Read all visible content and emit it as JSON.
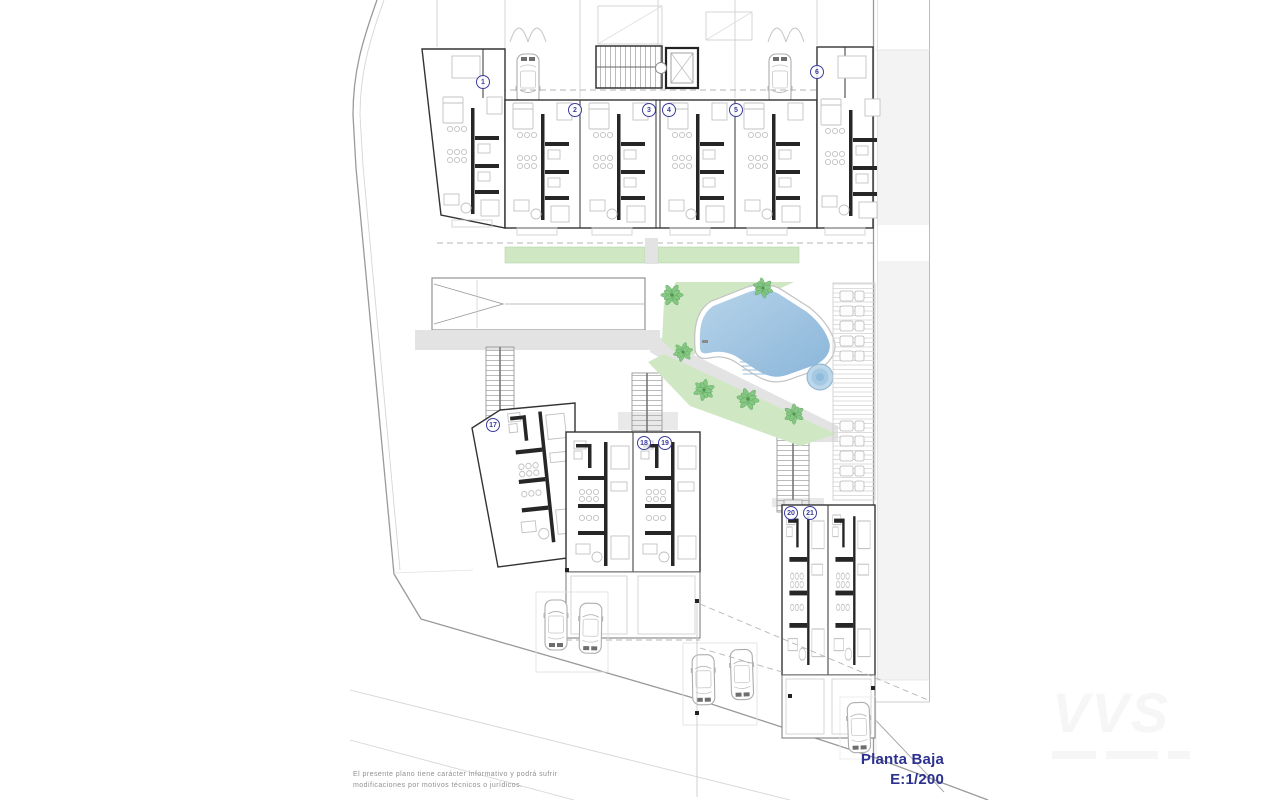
{
  "plan": {
    "title": {
      "name": "Planta Baja",
      "scale": "E:1/200"
    },
    "disclaimer": {
      "line1": "El  presente  plano  tiene  carácter  informativo  y  podrá  sufrir",
      "line2": "modificaciones por motivos técnicos o jurídicos."
    },
    "watermark": {
      "text": "VVS"
    },
    "units": {
      "top_row": [
        "1",
        "2",
        "3",
        "4",
        "5",
        "6"
      ],
      "bottom_row": [
        "17",
        "18",
        "19",
        "20",
        "21"
      ]
    }
  },
  "colors": {
    "accent_blue": "#2c3190",
    "badge_blue": "#3c3c9e",
    "disclaimer_gray": "#909090",
    "watermark_gray": "#f6f6f6",
    "wall": "#262626",
    "furniture": "#c2c2c2",
    "boundary": "#9a9a9a",
    "path_gray": "#e3e3e3",
    "green_area": "#cfe7c3",
    "palm_green": "#7cc57c",
    "pool_light": "#b7d4ea",
    "pool_dark": "#8ab5d9",
    "deck_line": "#d9d9d9",
    "side_strip": "#f3f3f3"
  }
}
